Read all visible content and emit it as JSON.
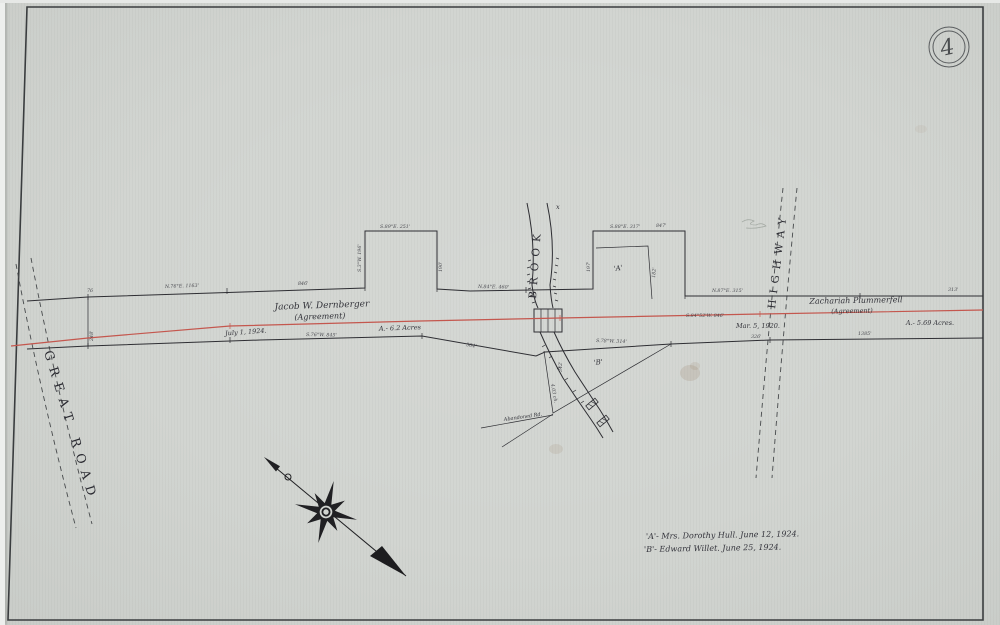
{
  "labels": {
    "sheet_number": "4",
    "great_road": "GREAT ROAD",
    "brook": "BROOK",
    "brook_x": "x",
    "highway": "HIGHWAY",
    "jacob_name": "Jacob W. Dernberger",
    "jacob_agreement": "(Agreement)",
    "jacob_date": "July 1, 1924.",
    "jacob_acres": "A.- 6.2 Acres",
    "zach_name": "Zachariah Plummerfell",
    "zach_agreement": "(Agreement)",
    "zach_date": "Mar. 5, 1920.",
    "zach_acres": "A.- 5.69 Acres.",
    "parcel_a": "'A'",
    "parcel_b": "'B'",
    "abandoned_road": "Abandoned Rd."
  },
  "notes": {
    "line1": "'A'- Mrs. Dorothy Hull.    June 12, 1924.",
    "line2": "'B'- Edward Willet.    June 25, 1924."
  },
  "annotations": [
    {
      "text": "N.76°E. 1163'"
    },
    {
      "text": "846'"
    },
    {
      "text": "S.3°W. 196'"
    },
    {
      "text": "S.89°E. 251'"
    },
    {
      "text": "190'"
    },
    {
      "text": "N.84°E. 460'"
    },
    {
      "text": "S.88°E. 317'"
    },
    {
      "text": "847'"
    },
    {
      "text": "197'"
    },
    {
      "text": "182'"
    },
    {
      "text": "N.87°E. 315'"
    },
    {
      "text": "313'"
    },
    {
      "text": "S.84°52'W. 846'"
    },
    {
      "text": "S.76°W. 845'"
    },
    {
      "text": "584'"
    },
    {
      "text": "S.78°W. 314'"
    },
    {
      "text": "1385'"
    },
    {
      "text": "326'"
    },
    {
      "text": "4.03 ch."
    },
    {
      "text": "76"
    },
    {
      "text": "342'"
    },
    {
      "text": "248'"
    }
  ],
  "colors": {
    "paper": "#d1d4d0",
    "ink": "#2e2e33",
    "pipeline_red": "#c4574e"
  }
}
